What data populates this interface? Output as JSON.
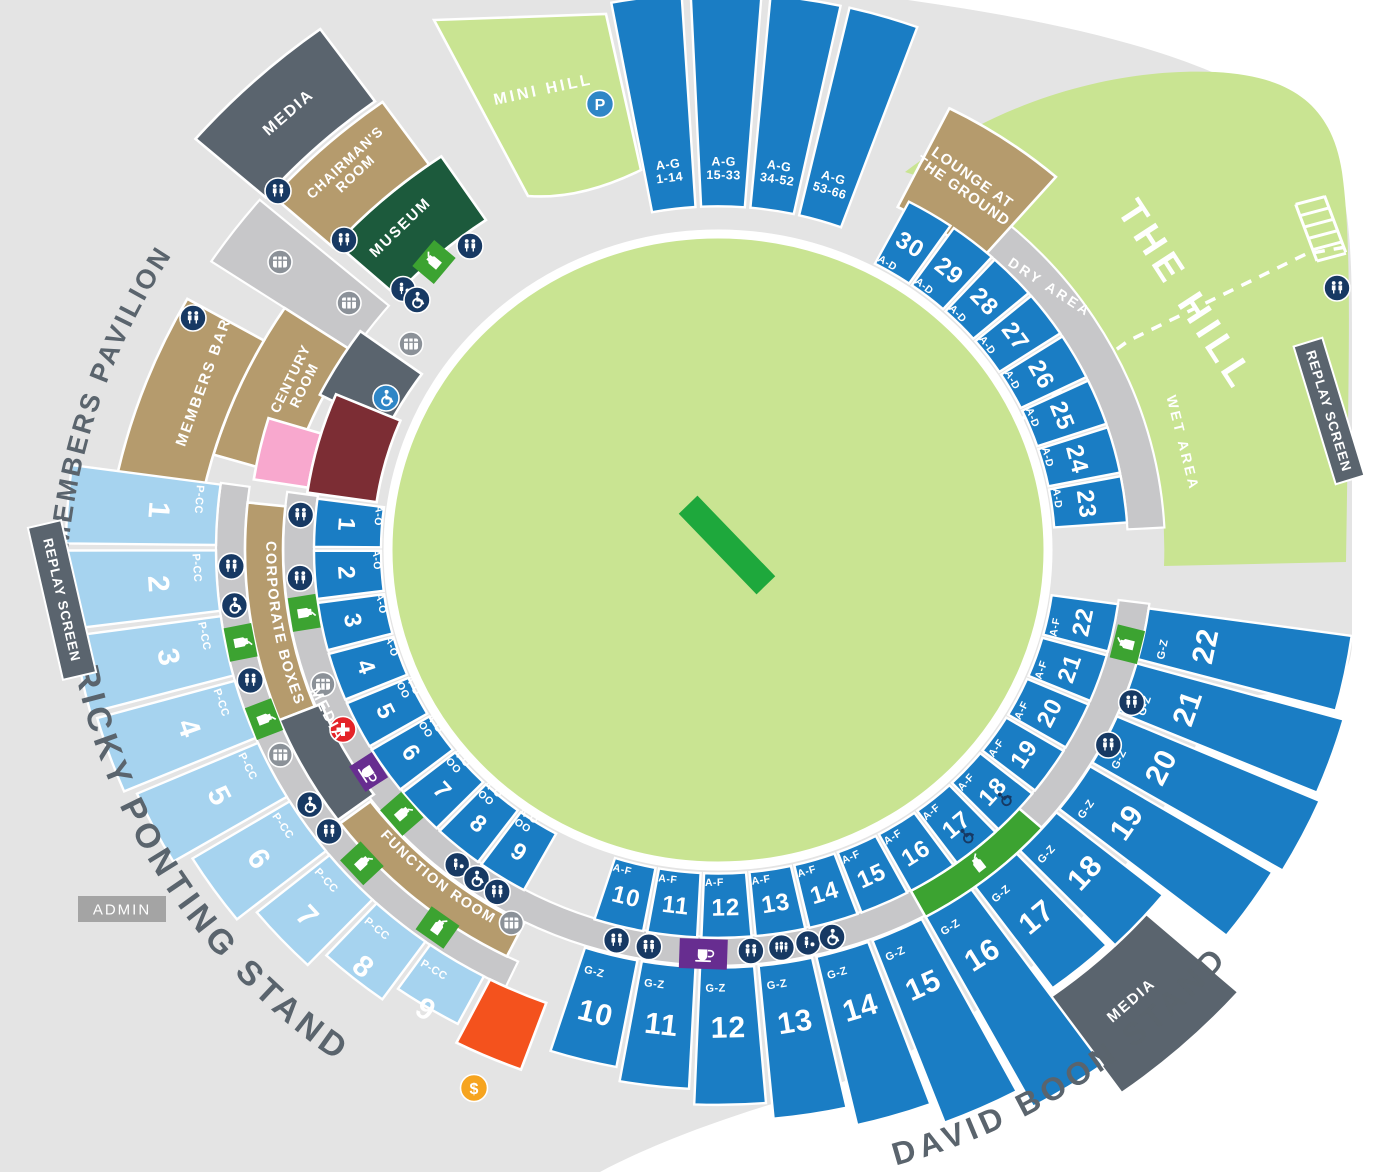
{
  "colors": {
    "bg": "#ffffff",
    "surround": "#e4e4e4",
    "walkway": "#c7c7c9",
    "field": "#c9e492",
    "pitch": "#1ea83c",
    "section_blue": "#1a7dc4",
    "section_lightblue": "#a6d3ef",
    "tan": "#b59b6d",
    "slate": "#5a646e",
    "museum_green": "#1c5a3c",
    "bright_green": "#3ca331",
    "navy": "#173963",
    "icon_blue": "#2f86c6",
    "pink": "#f8a8ce",
    "maroon": "#7c2d34",
    "orange": "#f4521d",
    "purple": "#672d90",
    "red": "#e42328",
    "gold": "#f6a41f",
    "label_dark": "#5a646d",
    "admin_gray": "#a4a4a4"
  },
  "labels": {
    "members_pavilion": "MEMBERS PAVILION",
    "ricky_ponting_stand": "RICKY PONTING STAND",
    "david_boon_stand": "DAVID BOON STAND",
    "media_nw": "MEDIA",
    "media_w": "MEDIA",
    "media_se": "MEDIA",
    "chairmans_room": "CHAIRMAN'S|ROOM",
    "museum": "MUSEUM",
    "members_bar": "MEMBERS BAR",
    "century_room": "CENTURY|ROOM",
    "corporate_boxes": "CORPORATE BOXES",
    "function_room": "FUNCTION ROOM",
    "lounge": "LOUNGE AT|THE GROUND",
    "the_hill": "THE HILL",
    "dry_area": "DRY AREA",
    "wet_area": "WET AREA",
    "mini_hill": "MINI HILL",
    "admin": "ADMIN",
    "replay_screen": "REPLAY SCREEN"
  },
  "sections": {
    "pavilion_front": [
      {
        "n": "1",
        "rows": "A-O"
      },
      {
        "n": "2",
        "rows": "A-O"
      },
      {
        "n": "3",
        "rows": "A-O"
      },
      {
        "n": "4",
        "rows": "A-O"
      },
      {
        "n": "5",
        "rows": "A-O|OO"
      },
      {
        "n": "6",
        "rows": "A-O|OO"
      },
      {
        "n": "7",
        "rows": "A-O|OO"
      },
      {
        "n": "8",
        "rows": "A-O|OO"
      },
      {
        "n": "9",
        "rows": "A-O|OO"
      }
    ],
    "lower_bowl": [
      {
        "n": "10",
        "rows": "A-F"
      },
      {
        "n": "11",
        "rows": "A-F"
      },
      {
        "n": "12",
        "rows": "A-F"
      },
      {
        "n": "13",
        "rows": "A-F"
      },
      {
        "n": "14",
        "rows": "A-F"
      },
      {
        "n": "15",
        "rows": "A-F"
      },
      {
        "n": "16",
        "rows": "A-F"
      },
      {
        "n": "17",
        "rows": "A-F"
      },
      {
        "n": "18",
        "rows": "A-F"
      },
      {
        "n": "19",
        "rows": "A-F"
      },
      {
        "n": "20",
        "rows": "A-F"
      },
      {
        "n": "21",
        "rows": "A-F"
      },
      {
        "n": "22",
        "rows": "A-F"
      }
    ],
    "upper_bowl": [
      {
        "n": "10",
        "rows": "G-Z"
      },
      {
        "n": "11",
        "rows": "G-Z"
      },
      {
        "n": "12",
        "rows": "G-Z"
      },
      {
        "n": "13",
        "rows": "G-Z"
      },
      {
        "n": "14",
        "rows": "G-Z"
      },
      {
        "n": "15",
        "rows": "G-Z"
      },
      {
        "n": "16",
        "rows": "G-Z"
      },
      {
        "n": "17",
        "rows": "G-Z"
      },
      {
        "n": "18",
        "rows": "G-Z"
      },
      {
        "n": "19",
        "rows": "G-Z"
      },
      {
        "n": "20",
        "rows": "G-Z"
      },
      {
        "n": "21",
        "rows": "G-Z"
      },
      {
        "n": "22",
        "rows": "G-Z"
      }
    ],
    "north_east": [
      {
        "n": "23",
        "rows": "A-D"
      },
      {
        "n": "24",
        "rows": "A-D"
      },
      {
        "n": "25",
        "rows": "A-D"
      },
      {
        "n": "26",
        "rows": "A-D"
      },
      {
        "n": "27",
        "rows": "A-D"
      },
      {
        "n": "28",
        "rows": "A-D"
      },
      {
        "n": "29",
        "rows": "A-D"
      },
      {
        "n": "30",
        "rows": "A-D"
      }
    ],
    "hill_terraces": [
      {
        "label": "A-G|1-14"
      },
      {
        "label": "A-G|15-33"
      },
      {
        "label": "A-G|34-52"
      },
      {
        "label": "A-G|53-66"
      }
    ],
    "ricky_ponting": [
      {
        "n": "1",
        "rows": "P-CC"
      },
      {
        "n": "2",
        "rows": "P-CC"
      },
      {
        "n": "3",
        "rows": "P-CC"
      },
      {
        "n": "4",
        "rows": "P-CC"
      },
      {
        "n": "5",
        "rows": "P-CC"
      },
      {
        "n": "6",
        "rows": "P-CC"
      },
      {
        "n": "7",
        "rows": "P-CC"
      },
      {
        "n": "8",
        "rows": "P-CC"
      },
      {
        "n": "9",
        "rows": "P-CC"
      }
    ]
  },
  "icons": [
    {
      "t": "p",
      "x": 600,
      "y": 104
    },
    {
      "t": "wc",
      "x": 278,
      "y": 191
    },
    {
      "t": "wc",
      "x": 344,
      "y": 240
    },
    {
      "t": "wc",
      "x": 470,
      "y": 246
    },
    {
      "t": "wc",
      "x": 193,
      "y": 318
    },
    {
      "t": "wc",
      "x": 1337,
      "y": 288
    },
    {
      "t": "food",
      "x": 434,
      "y": 262,
      "r": -50
    },
    {
      "t": "baby",
      "x": 403,
      "y": 289
    },
    {
      "t": "acc",
      "x": 417,
      "y": 300
    },
    {
      "t": "atm",
      "x": 280,
      "y": 262
    },
    {
      "t": "atm",
      "x": 349,
      "y": 303
    },
    {
      "t": "atm",
      "x": 411,
      "y": 344
    },
    {
      "t": "accb",
      "x": 386,
      "y": 398
    },
    {
      "t": "wc",
      "pc": [
        185,
        419
      ]
    },
    {
      "t": "wc",
      "pc": [
        176,
        419
      ]
    },
    {
      "t": "food",
      "pc": [
        171,
        419
      ],
      "r": 81
    },
    {
      "t": "atm",
      "pc": [
        160.5,
        419
      ]
    },
    {
      "t": "aid",
      "pc": [
        153.5,
        419
      ]
    },
    {
      "t": "cafe",
      "pc": [
        146.5,
        419
      ],
      "r": 57
    },
    {
      "t": "food",
      "pc": [
        139,
        419
      ],
      "r": 49
    },
    {
      "t": "baby",
      "pc": [
        128.5,
        419
      ]
    },
    {
      "t": "acc",
      "pc": [
        125.2,
        419
      ]
    },
    {
      "t": "wc",
      "pc": [
        121.8,
        419
      ]
    },
    {
      "t": "atm",
      "pc": [
        118,
        440
      ]
    },
    {
      "t": "wc",
      "pc": [
        178,
        487
      ]
    },
    {
      "t": "acc",
      "pc": [
        173.2,
        487
      ]
    },
    {
      "t": "food",
      "pc": [
        168.6,
        487
      ],
      "r": 79
    },
    {
      "t": "wc",
      "pc": [
        163.8,
        487
      ]
    },
    {
      "t": "food",
      "pc": [
        158.8,
        487
      ],
      "r": 69
    },
    {
      "t": "atm",
      "pc": [
        154,
        487
      ]
    },
    {
      "t": "acc",
      "pc": [
        147,
        487
      ]
    },
    {
      "t": "wc",
      "pc": [
        143,
        487
      ]
    },
    {
      "t": "food",
      "pc": [
        137.5,
        483
      ],
      "r": 47
    },
    {
      "t": "food",
      "pc": [
        125.5,
        483
      ],
      "r": 35
    },
    {
      "t": "wc",
      "pc": [
        104,
        419
      ]
    },
    {
      "t": "wc",
      "pc": [
        99.5,
        419
      ]
    },
    {
      "t": "caferect",
      "pc": [
        92,
        421
      ],
      "r": 2
    },
    {
      "t": "wc",
      "pc": [
        85.5,
        419
      ]
    },
    {
      "t": "wc3",
      "pc": [
        81.3,
        419
      ]
    },
    {
      "t": "baby",
      "pc": [
        77.6,
        419
      ]
    },
    {
      "t": "acc",
      "pc": [
        74.2,
        419
      ]
    },
    {
      "t": "bottle",
      "pc": [
        51.5,
        419
      ],
      "r": -38
    },
    {
      "t": "accp",
      "x": 966,
      "y": 836,
      "r": -40
    },
    {
      "t": "accp",
      "x": 1004,
      "y": 799,
      "r": -48
    },
    {
      "t": "wc",
      "pc": [
        27.5,
        440
      ]
    },
    {
      "t": "wc",
      "pc": [
        21,
        443
      ]
    },
    {
      "t": "food",
      "pc": [
        13.5,
        421
      ],
      "r": -76
    },
    {
      "t": "dollar",
      "x": 474,
      "y": 1088
    },
    {
      "t": "steps",
      "x": 1318,
      "y": 230,
      "r": -13
    }
  ],
  "geometry": {
    "c1": [
      718,
      550
    ],
    "c2": [
      760,
      610
    ],
    "ky": 0.96,
    "walkways": [
      {
        "c": "c1",
        "a": [
          188,
          7.4
        ],
        "r": [
          404,
          435
        ]
      },
      {
        "c": "c1",
        "a": [
          188,
          115
        ],
        "r": [
          473,
          502
        ]
      },
      {
        "c": "c1",
        "a": [
          -3,
          -62.5
        ],
        "r": [
          410,
          447
        ]
      },
      {
        "c": "c2",
        "a": [
          -146.5,
          -139.5
        ],
        "r": [
          488,
          658
        ]
      }
    ],
    "groups": {
      "pavilion_front": {
        "a0": 187.6,
        "step": -7.72,
        "w": 7.12,
        "r0": 337,
        "r1": 404,
        "numR": 372,
        "numSize": 24,
        "rowR": 341,
        "rowDa": 2,
        "rowSize": 10.5,
        "fill": "section_blue"
      },
      "lower_bowl": {
        "a0": 107.8,
        "step": -7.72,
        "w": 7.12,
        "r0": 337,
        "r1": 404,
        "numR": 372,
        "numSize": 24,
        "rowR": 346,
        "rowDa": 1.8,
        "rowSize": 10.5,
        "fill": "section_blue"
      },
      "upper_bowl": {
        "a0": 107.8,
        "step": -7.72,
        "w": 7.12,
        "r0": 435,
        "r1List": [
          548,
          562,
          578,
          595,
          615,
          638,
          660,
          566,
          572,
          648,
          656,
          650,
          640
        ],
        "numR": 497,
        "numSize": 30,
        "rowR": 456,
        "rowDa": 1.5,
        "rowSize": 11,
        "fill": "section_blue"
      },
      "north_east": {
        "a0": -4.0,
        "step": -7.35,
        "w": 6.8,
        "r0": 337,
        "r1": 410,
        "numR": 372,
        "numSize": 24,
        "rowR": 344,
        "rowDa": -1.6,
        "rowSize": 10.5,
        "fill": "section_blue"
      },
      "hill_terraces": {
        "a0": -100.6,
        "step": 7.9,
        "w": 7.0,
        "r0": 358,
        "r1": 580,
        "numR": 398,
        "numSize": 12.5,
        "fill": "section_blue"
      },
      "ricky_ponting": {
        "a0": 187.8,
        "step": -7.85,
        "w": 7.2,
        "r0": 502,
        "r1List": [
          652,
          652,
          650,
          645,
          634,
          616,
          596,
          576,
          558
        ],
        "numR": 560,
        "numSize": 30,
        "rowR": 521,
        "rowDa": 1.6,
        "rowSize": 11,
        "fill": "section_lightblue"
      }
    },
    "areas": [
      {
        "name": "century-room",
        "c": "c2",
        "a": [
          -163.5,
          -146.5
        ],
        "r": [
          490,
          570
        ],
        "fill": "tan"
      },
      {
        "name": "members-bar",
        "c": "c2",
        "a": [
          -171,
          -150.5
        ],
        "r": [
          570,
          658
        ],
        "fill": "tan"
      },
      {
        "name": "pavilion-wing",
        "c": "c2",
        "a": [
          -153,
          -144
        ],
        "r": [
          418,
          494
        ],
        "fill": "slate"
      },
      {
        "name": "museum",
        "c": "c2",
        "a": [
          -138,
          -124
        ],
        "r": [
          490,
          570
        ],
        "fill": "museum_green"
      },
      {
        "name": "chairmans-room",
        "c": "c2",
        "a": [
          -138.5,
          -125.5
        ],
        "r": [
          570,
          650
        ],
        "fill": "tan"
      },
      {
        "name": "media-northwest",
        "c": "c2",
        "a": [
          -139,
          -126
        ],
        "r": [
          655,
          748
        ],
        "fill": "slate"
      },
      {
        "name": "pink-room",
        "c": "c1",
        "a": [
          197,
          189
        ],
        "r": [
          415,
          470
        ],
        "fill": "pink"
      },
      {
        "name": "maroon-room",
        "c": "c1",
        "a": [
          203,
          188.3
        ],
        "r": [
          345,
          415
        ],
        "fill": "maroon"
      },
      {
        "name": "corporate-boxes",
        "c": "c1",
        "a": [
          186,
          158
        ],
        "r": [
          435,
          473
        ],
        "fill": "tan"
      },
      {
        "name": "media-west",
        "c": "c1",
        "a": [
          158,
          143.5
        ],
        "r": [
          428,
          473
        ],
        "fill": "slate"
      },
      {
        "name": "function-room",
        "c": "c1",
        "a": [
          143,
          116.5
        ],
        "r": [
          435,
          473
        ],
        "fill": "tan"
      },
      {
        "name": "lounge-at-the-ground",
        "c": "c1",
        "a": [
          -49,
          -63.3
        ],
        "r": [
          400,
          515
        ],
        "fill": "tan"
      },
      {
        "name": "media-southeast",
        "c": "c1",
        "a": [
          54.5,
          41.5
        ],
        "r": [
          572,
          695
        ],
        "fill": "slate"
      },
      {
        "name": "food-walk-band",
        "c": "c1",
        "a": [
          61.5,
          41.8
        ],
        "r": [
          404,
          435
        ],
        "fill": "bright_green"
      },
      {
        "name": "orange-section",
        "c": "c1",
        "a": [
          117,
          110
        ],
        "r": [
          502,
          576
        ],
        "fill": "orange"
      },
      {
        "name": "mini-hill",
        "path": "M434,20 L606,14 L641,170 Q580,200 528,196 Z",
        "fill": "field"
      }
    ],
    "placed_labels": [
      [
        "media_nw",
        288,
        112,
        -41,
        16,
        2
      ],
      [
        "chairmans_room",
        350,
        168,
        -43,
        14,
        1
      ],
      [
        "museum",
        400,
        227,
        -44,
        15,
        2
      ],
      [
        "members_bar",
        203,
        382,
        -70,
        15,
        2
      ],
      [
        "century_room",
        297,
        382,
        -64,
        14,
        1
      ],
      [
        "lounge",
        968,
        184,
        35,
        15,
        1
      ],
      [
        "mini_hill",
        543,
        89,
        -12,
        16,
        3
      ],
      [
        "the_hill",
        1187,
        295,
        57,
        38,
        6
      ],
      [
        "dry_area",
        1050,
        287,
        33,
        14,
        3
      ],
      [
        "wet_area",
        1183,
        443,
        76,
        14,
        3
      ],
      [
        "media_w",
        328,
        714,
        63,
        15,
        2
      ],
      [
        "media_se",
        1131,
        1000,
        -41,
        15,
        2
      ]
    ]
  }
}
